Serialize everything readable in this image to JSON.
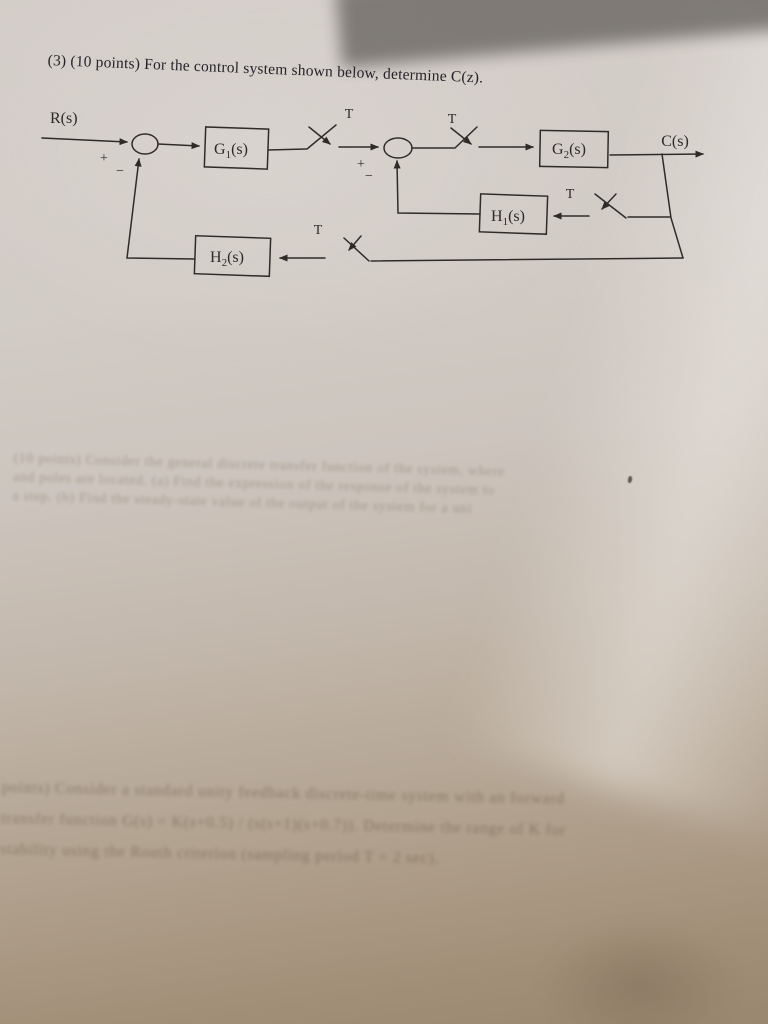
{
  "page": {
    "title": "(3) (10 points) For the control system shown below, determine C(z)."
  },
  "diagram": {
    "input_label": "R(s)",
    "output_label": "C(s)",
    "sampler_period_labels": {
      "t1": "T",
      "t2": "T",
      "t3": "T",
      "t4": "T"
    },
    "sum1": {
      "plus": "+",
      "minus": "−"
    },
    "sum2": {
      "plus": "+",
      "minus": "−"
    },
    "blocks": {
      "g1": {
        "base": "G",
        "sub": "1",
        "args": "(s)"
      },
      "g2": {
        "base": "G",
        "sub": "2",
        "args": "(s)"
      },
      "h1": {
        "base": "H",
        "sub": "1",
        "args": "(s)"
      },
      "h2": {
        "base": "H",
        "sub": "2",
        "args": "(s)"
      }
    }
  },
  "bleed_through": {
    "middle": [
      "(10 points) Consider the general discrete transfer function of the system, where",
      "and poles are located. (a) Find the expression of the response of the system to",
      "a step. (b) Find the steady-state value of the output of the system for a unit"
    ],
    "bottom": [
      "points) Consider a standard unity feedback discrete-time system with an forward",
      "transfer function G(s) = K(s+0.5) / (s(s+1)(s+0.7)). Determine the range of K for",
      "stability using the Routh criterion (sampling period T = 2 sec)."
    ]
  }
}
